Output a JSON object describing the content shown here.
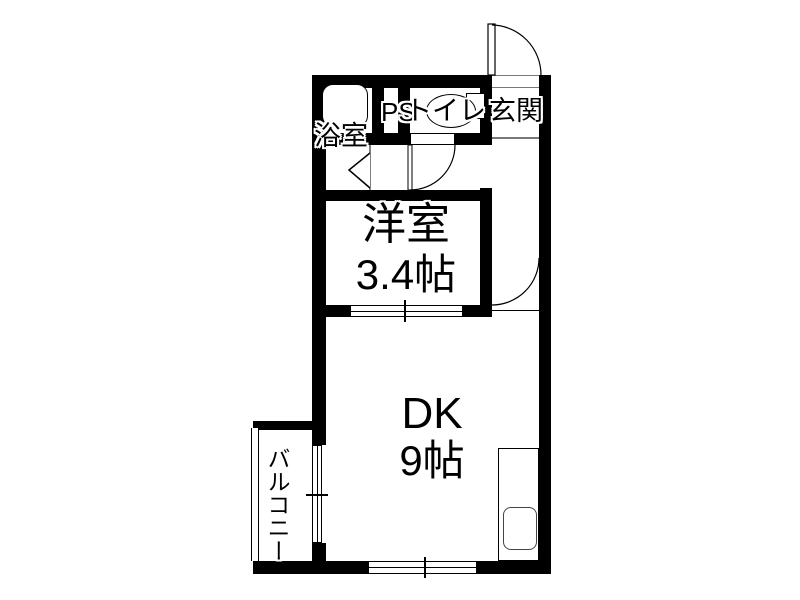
{
  "plan_title": "1DK apartment floor plan",
  "colors": {
    "wall": "#000000",
    "line": "#000000",
    "background": "#ffffff",
    "step_line": "#777777"
  },
  "rooms": {
    "bathroom": {
      "label": "浴室"
    },
    "pipe_space": {
      "label": "PS"
    },
    "toilet": {
      "label": "トイレ"
    },
    "entrance": {
      "label": "玄関"
    },
    "western_room": {
      "label": "洋室",
      "size": "3.4帖"
    },
    "dining_kitchen": {
      "label": "DK",
      "size": "9帖"
    },
    "balcony": {
      "label": "バルコニー"
    }
  },
  "icons": [
    "bathtub-icon",
    "toilet-bowl-icon",
    "toilet-tank-icon",
    "kitchen-counter-icon",
    "kitchen-sink-icon",
    "entrance-door-swing-icon",
    "toilet-door-swing-icon",
    "hallway-door-swing-icon",
    "bathroom-folding-door-icon",
    "sliding-window-icon"
  ]
}
